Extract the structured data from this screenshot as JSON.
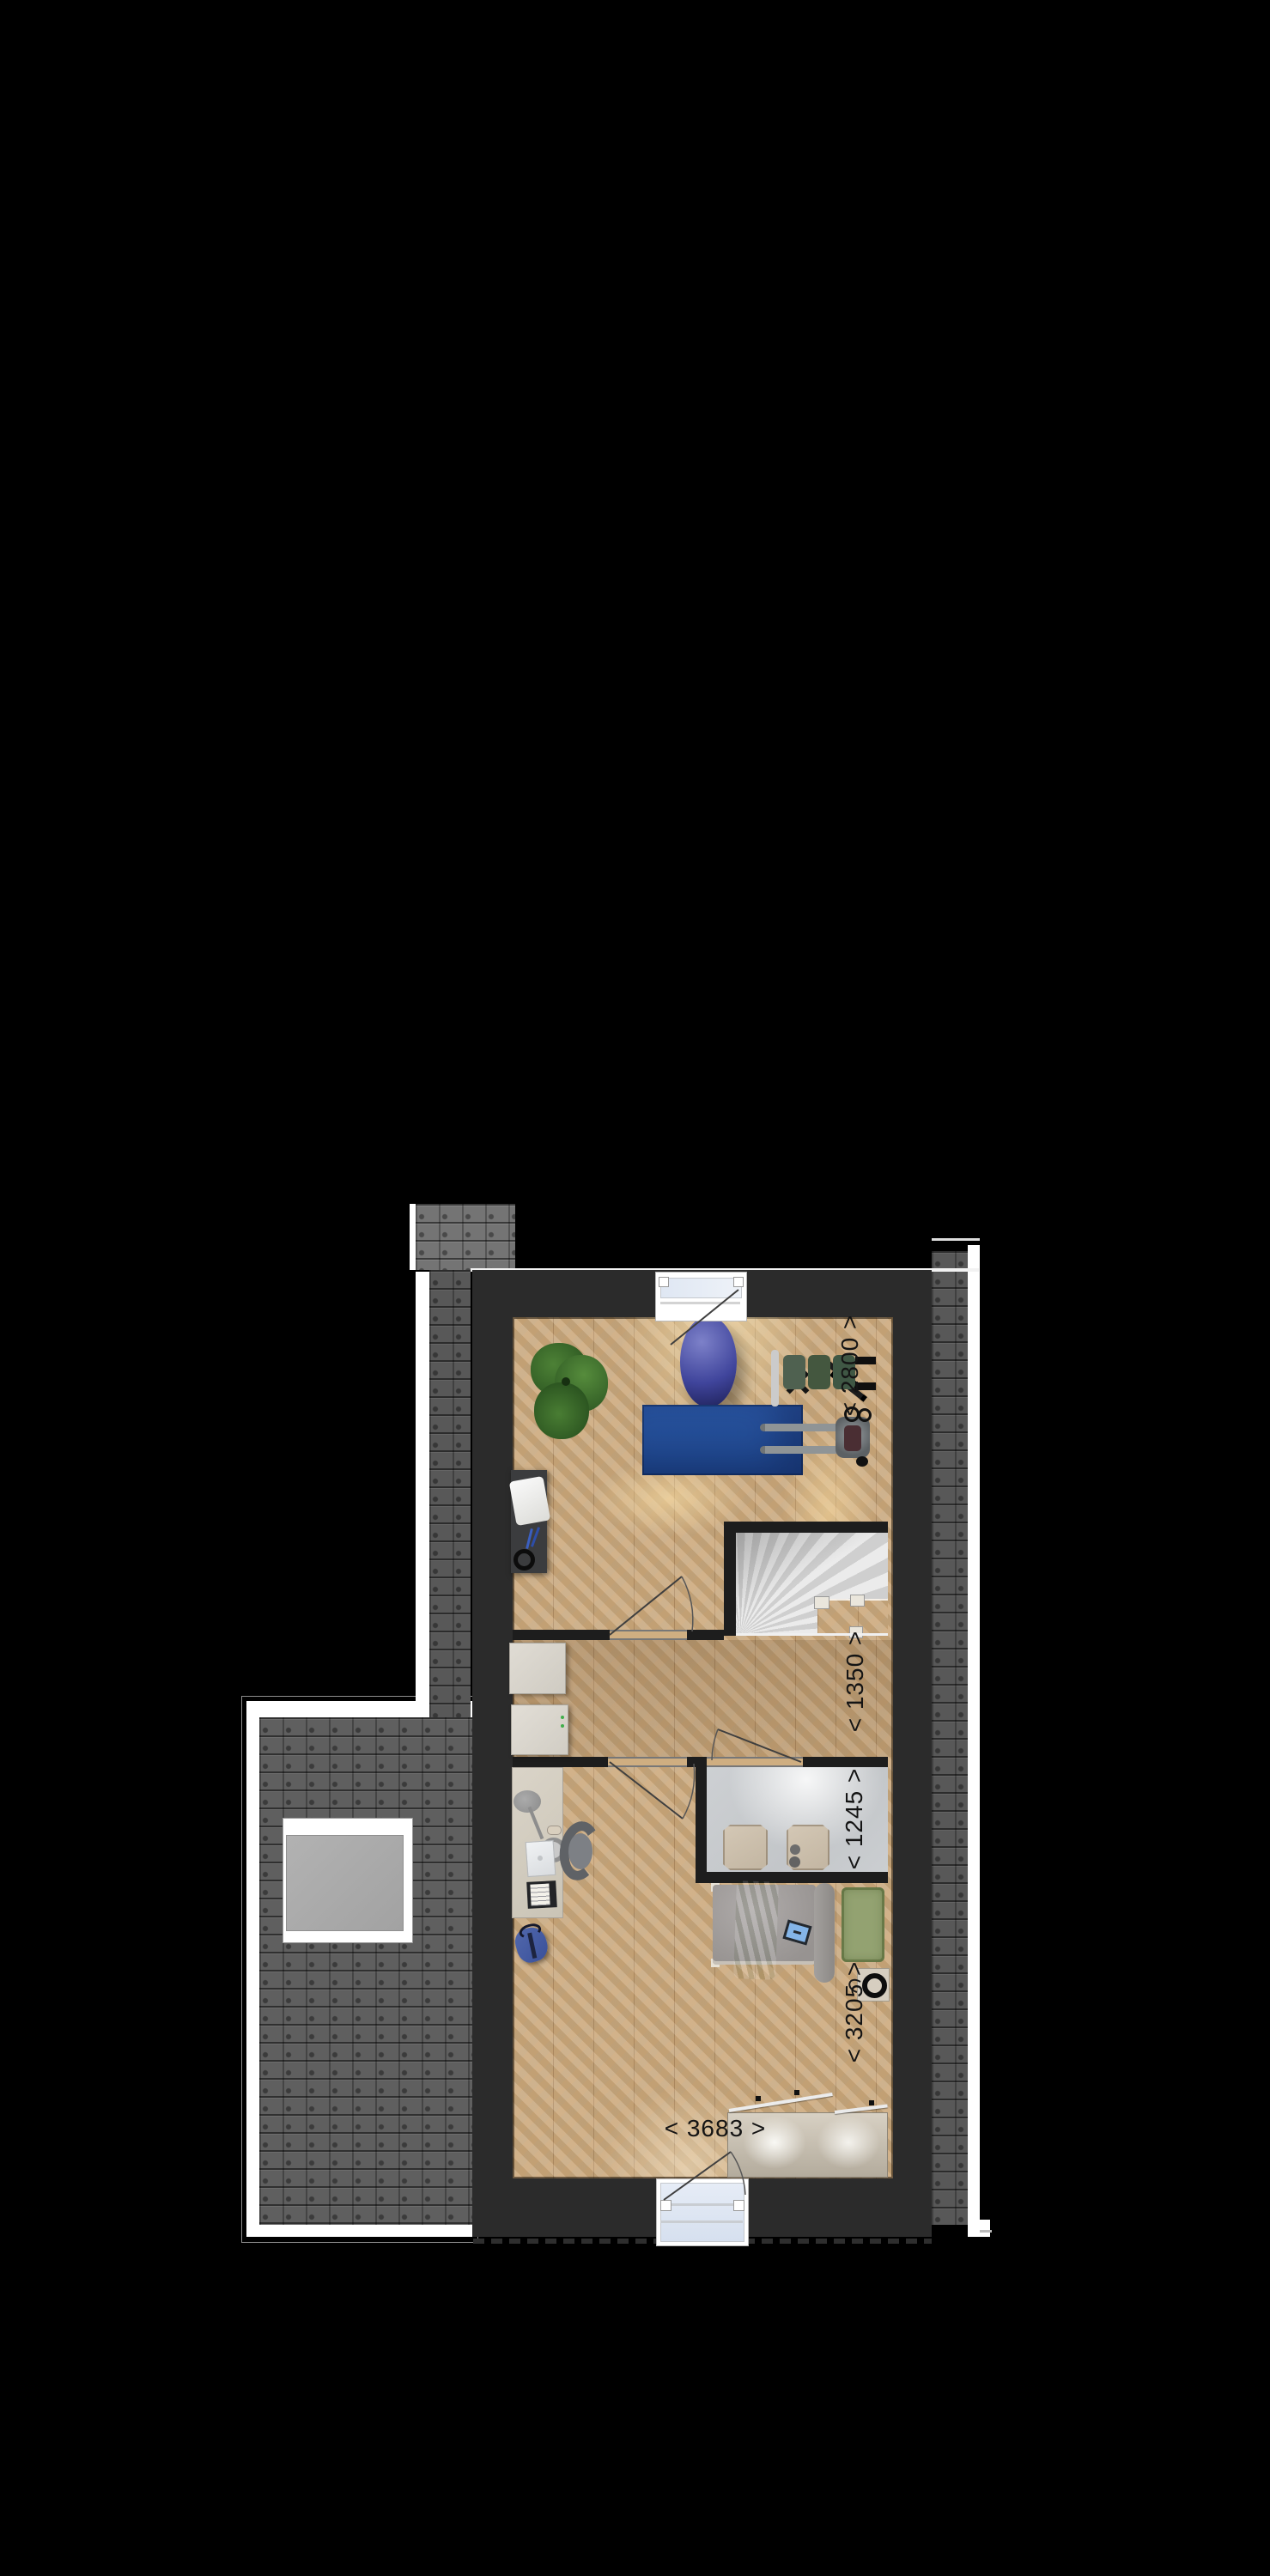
{
  "dimension_labels": {
    "gym_width": "< 2800 >",
    "landing_depth": "< 1350 >",
    "bathroom_depth": "< 1245 >",
    "bedroom_depth": "< 3205 >",
    "bedroom_width": "< 3683 >"
  },
  "colors": {
    "background": "#000000",
    "wall": "#2b2b2b",
    "floor_wood": "#d2b083",
    "roof_tile": "#585858",
    "roof_trim": "#ffffff",
    "bathroom_floor": "#cbced1",
    "stairs": "#dedede",
    "rug_blue": "#28539f",
    "rug_green": "#93a271",
    "label_text": "#141414"
  }
}
